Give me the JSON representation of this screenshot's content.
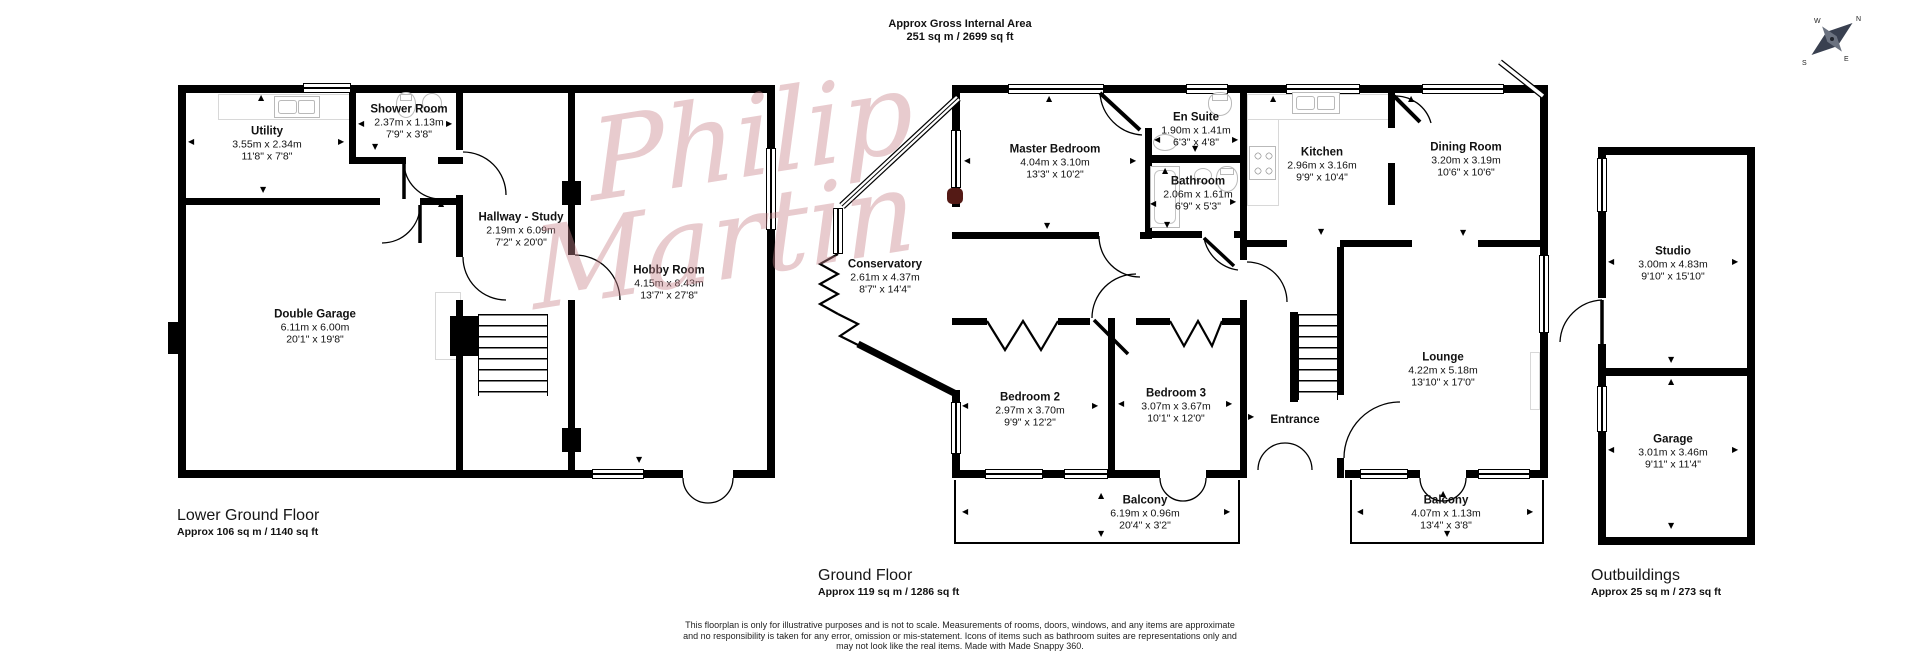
{
  "header": {
    "line1": "Approx Gross Internal Area",
    "line2": "251 sq m / 2699 sq ft"
  },
  "watermark": {
    "line1": "Philip",
    "line2": "Martin"
  },
  "compass": {
    "n": "N",
    "e": "E",
    "s": "S",
    "w": "W"
  },
  "icons": {
    "up": "▲",
    "down": "▼",
    "left": "◀",
    "right": "▶"
  },
  "colors": {
    "wall": "#000000",
    "fixture": "#b9b9b9",
    "watermark": "#c9858d"
  },
  "floors": [
    {
      "name": "Lower Ground Floor",
      "area": "Approx 106 sq m / 1140 sq ft"
    },
    {
      "name": "Ground Floor",
      "area": "Approx 119 sq m / 1286 sq ft"
    },
    {
      "name": "Outbuildings",
      "area": "Approx 25 sq m / 273 sq ft"
    }
  ],
  "rooms": {
    "utility": {
      "name": "Utility",
      "metric": "3.55m x 2.34m",
      "imperial": "11'8\" x 7'8\""
    },
    "shower_room": {
      "name": "Shower Room",
      "metric": "2.37m x 1.13m",
      "imperial": "7'9\" x 3'8\""
    },
    "hallway_study": {
      "name": "Hallway - Study",
      "metric": "2.19m x 6.09m",
      "imperial": "7'2\" x 20'0\""
    },
    "double_garage": {
      "name": "Double Garage",
      "metric": "6.11m x 6.00m",
      "imperial": "20'1\" x 19'8\""
    },
    "hobby_room": {
      "name": "Hobby Room",
      "metric": "4.15m x 8.43m",
      "imperial": "13'7\" x 27'8\""
    },
    "master_bedroom": {
      "name": "Master Bedroom",
      "metric": "4.04m x 3.10m",
      "imperial": "13'3\" x 10'2\""
    },
    "en_suite": {
      "name": "En Suite",
      "metric": "1.90m x 1.41m",
      "imperial": "6'3\" x 4'8\""
    },
    "bathroom": {
      "name": "Bathroom",
      "metric": "2.06m x 1.61m",
      "imperial": "6'9\" x 5'3\""
    },
    "kitchen": {
      "name": "Kitchen",
      "metric": "2.96m x 3.16m",
      "imperial": "9'9\" x 10'4\""
    },
    "dining_room": {
      "name": "Dining Room",
      "metric": "3.20m x 3.19m",
      "imperial": "10'6\" x 10'6\""
    },
    "conservatory": {
      "name": "Conservatory",
      "metric": "2.61m x 4.37m",
      "imperial": "8'7\" x 14'4\""
    },
    "bedroom_2": {
      "name": "Bedroom 2",
      "metric": "2.97m x 3.70m",
      "imperial": "9'9\" x 12'2\""
    },
    "bedroom_3": {
      "name": "Bedroom 3",
      "metric": "3.07m x 3.67m",
      "imperial": "10'1\" x 12'0\""
    },
    "entrance": {
      "name": "Entrance"
    },
    "lounge": {
      "name": "Lounge",
      "metric": "4.22m x 5.18m",
      "imperial": "13'10\" x 17'0\""
    },
    "balcony_a": {
      "name": "Balcony",
      "metric": "6.19m x 0.96m",
      "imperial": "20'4\" x 3'2\""
    },
    "balcony_b": {
      "name": "Balcony",
      "metric": "4.07m x 1.13m",
      "imperial": "13'4\" x 3'8\""
    },
    "studio": {
      "name": "Studio",
      "metric": "3.00m x 4.83m",
      "imperial": "9'10\" x 15'10\""
    },
    "garage": {
      "name": "Garage",
      "metric": "3.01m x 3.46m",
      "imperial": "9'11\" x 11'4\""
    }
  },
  "disclaimer": {
    "line1": "This floorplan is only for illustrative purposes and is not to scale. Measurements of rooms, doors, windows, and any items are approximate",
    "line2": "and no responsibility is taken for any error, omission or mis-statement. Icons of items such as bathroom suites are representations only and",
    "line3": "may not look like the real items. Made with Made Snappy 360."
  }
}
